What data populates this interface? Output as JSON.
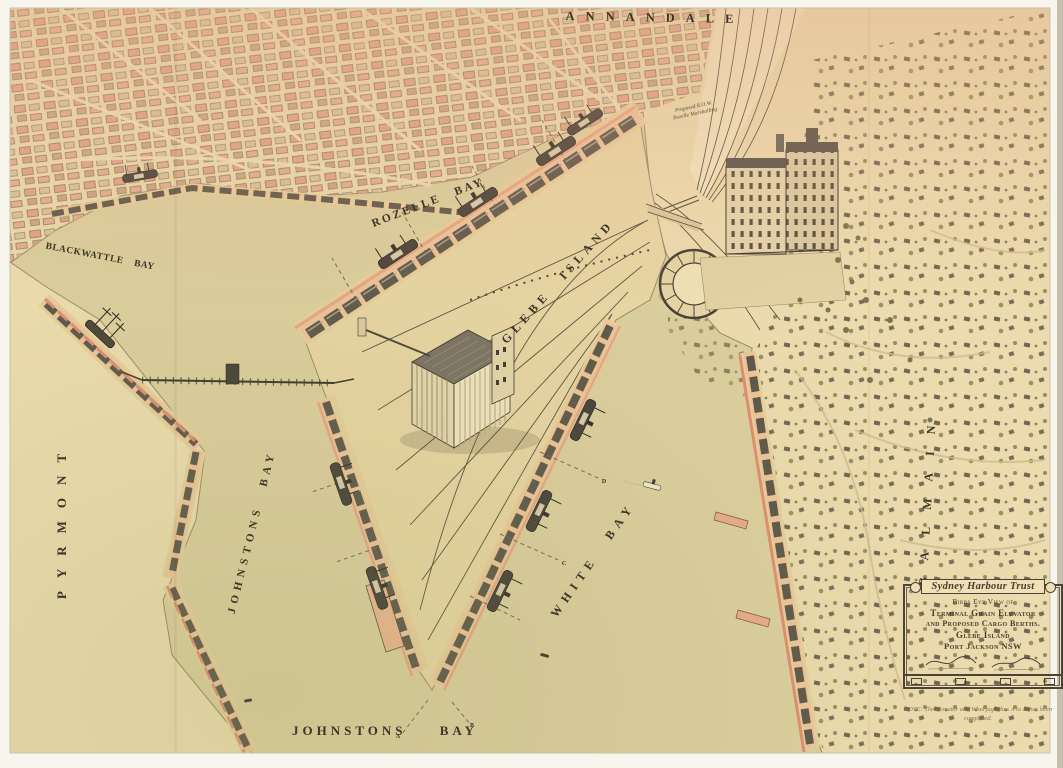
{
  "labels": {
    "annandale": "ANNANDALE",
    "rozelle_bay": "ROZELLE BAY",
    "blackwattle_bay": "BLACKWATTLE BAY",
    "glebe_island": "GLEBE ISLAND",
    "pyrmont": "PYRMONT",
    "johnstons_bay_west": "JOHNSTONS BAY",
    "white_bay": "WHITE BAY",
    "johnstons_bay_south": "JOHNSTONS BAY",
    "balmain": "BALMAIN"
  },
  "annotations": {
    "proposed_row": "Proposed R.O.W.",
    "marshalling": "Rozelle Marshalling"
  },
  "berths": [
    "A",
    "B",
    "C",
    "D"
  ],
  "cartouche": {
    "title": "Sydney Harbour Trust",
    "line1": "Birds Eye View of",
    "line2": "Terminal Grain Elevator",
    "line3": "and Proposed Cargo Berths.",
    "line4": "Glebe Island",
    "line5": "Port Jackson NSW"
  },
  "note": "NOTE: The Elevator and Wharfage thus A to D has been completed.",
  "colors": {
    "paper": "#f8f5ec",
    "water": "#ddcf9f",
    "land": "#ecdbae",
    "wharf_apron": "#e9cf9c",
    "wharf_salmon": "#eec49a",
    "shed_roof": "#5d564a",
    "accent_salmon": "#e8a683",
    "ink": "#3f382c",
    "foliage": "#6f6b45"
  }
}
